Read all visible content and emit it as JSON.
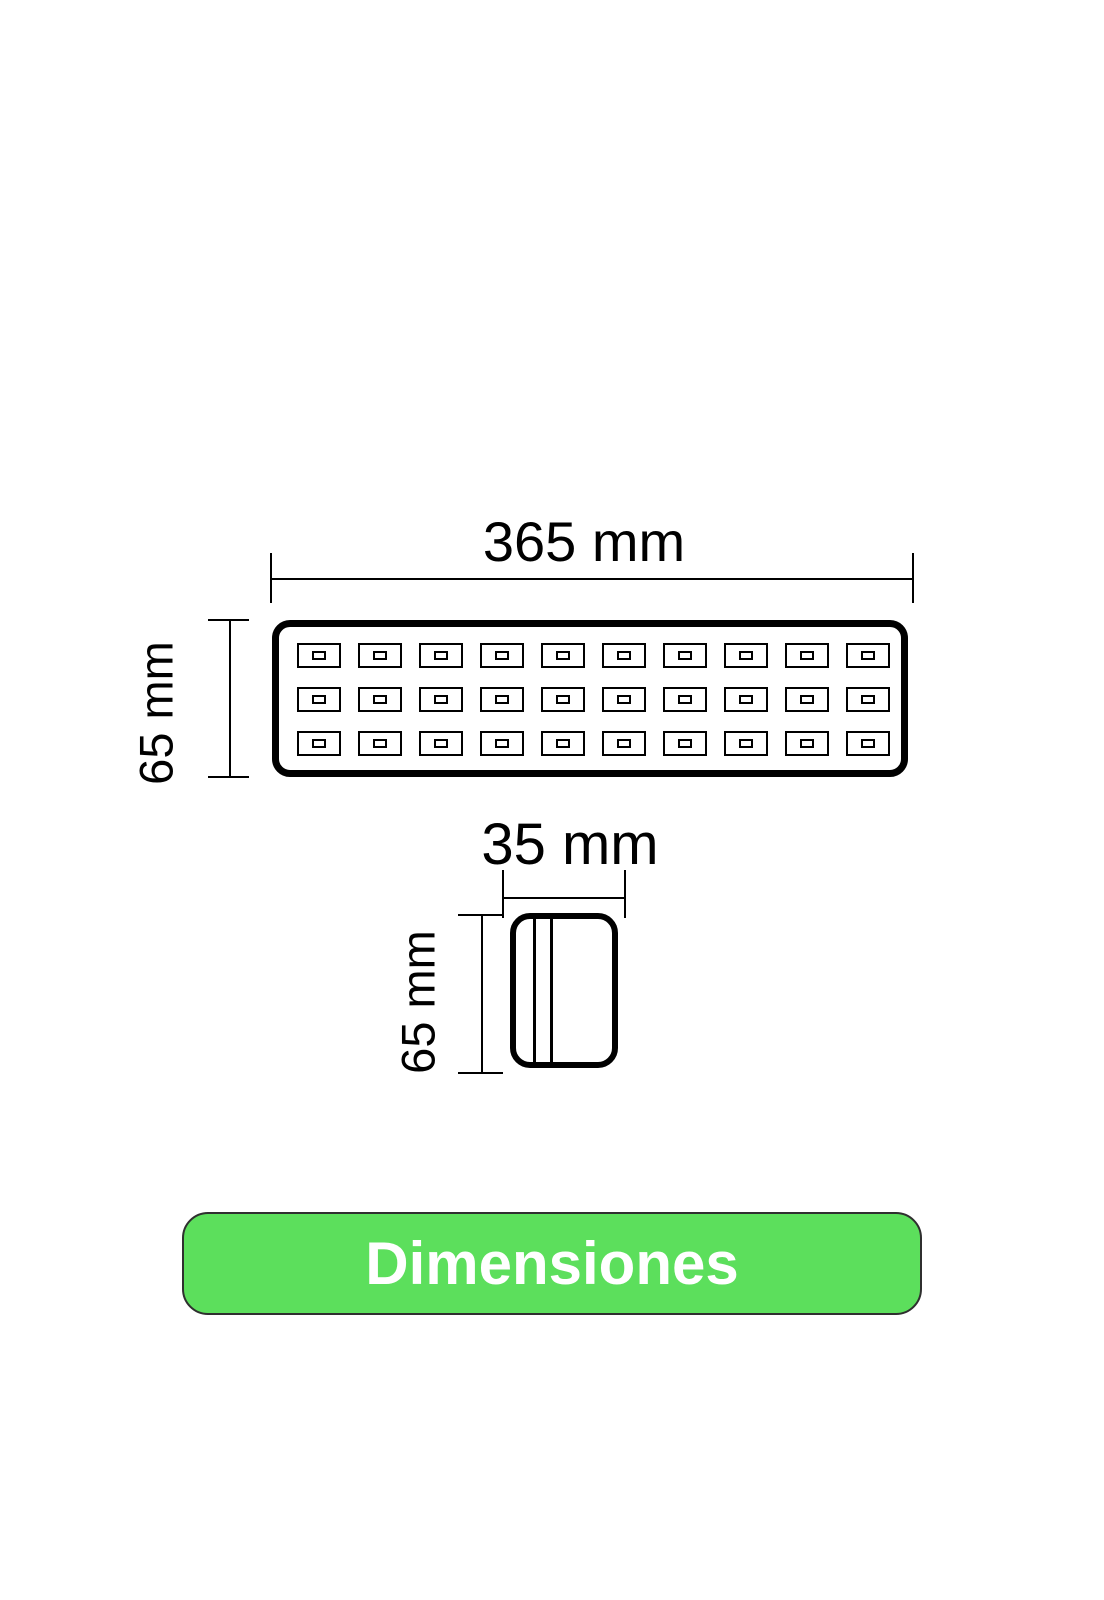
{
  "background_color": "#ffffff",
  "line_color": "#000000",
  "diagram": {
    "top_view": {
      "width_label": "365 mm",
      "height_label": "65 mm",
      "led_grid": {
        "rows": 3,
        "columns": 10
      }
    },
    "side_view": {
      "width_label": "35 mm",
      "height_label": "65 mm"
    }
  },
  "footer_button": {
    "label": "Dimensiones",
    "background_color": "#5cdf5c",
    "label_color": "#ffffff",
    "border_color": "#2f2f2f"
  }
}
